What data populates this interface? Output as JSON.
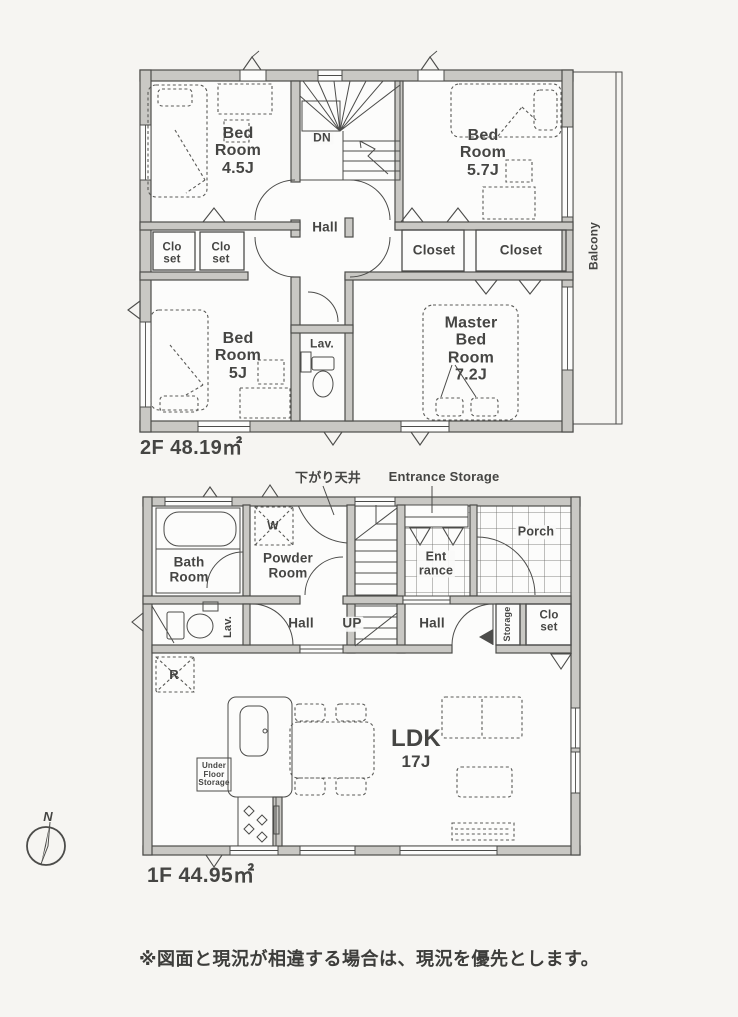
{
  "floor2": {
    "area_label": "2F 48.19㎡",
    "labels": {
      "bedroom_4_5": "Bed\nRoom\n4.5J",
      "bedroom_5_7": "Bed\nRoom\n5.7J",
      "bedroom_5": "Bed\nRoom\n5J",
      "master_bedroom": "Master\nBed\nRoom\n7.2J",
      "closet_small_1": "Clo\nset",
      "closet_small_2": "Clo\nset",
      "closet_1": "Closet",
      "closet_2": "Closet",
      "hall": "Hall",
      "down": "DN",
      "lavatory": "Lav.",
      "balcony": "Balcony"
    }
  },
  "floor1": {
    "area_label": "1F 44.95㎡",
    "annotations": {
      "lowered_ceiling": "下がり天井",
      "entrance_storage": "Entrance Storage"
    },
    "labels": {
      "bath": "Bath\nRoom",
      "powder": "Powder\nRoom",
      "washer": "W",
      "lavatory": "Lav.",
      "hall_left": "Hall",
      "up": "UP",
      "hall_right": "Hall",
      "entrance": "Ent\nrance",
      "porch": "Porch",
      "storage": "Storage",
      "closet": "Clo\nset",
      "refrigerator": "R",
      "under_floor_storage": "Under\nFloor\nStorage",
      "ldk": "LDK",
      "ldk_size": "17J"
    }
  },
  "compass": {
    "north": "N"
  },
  "disclaimer": "※図面と現況が相違する場合は、現況を優先とします。",
  "colors": {
    "line": "#4c4c4a",
    "wall_fill": "#c9c8c4",
    "paper": "#f6f5f2",
    "floor": "#fcfcfb",
    "text": "#474745"
  }
}
